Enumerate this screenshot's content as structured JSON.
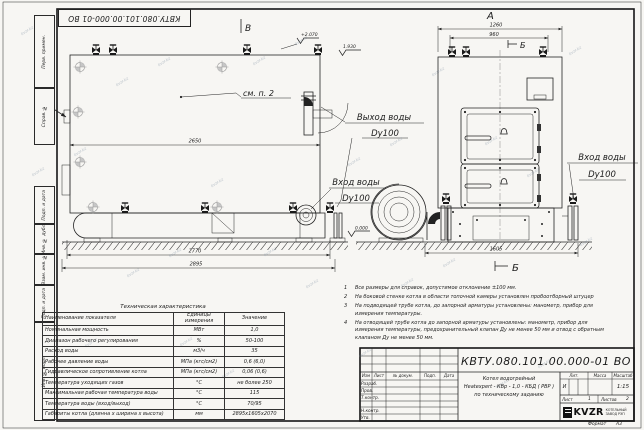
{
  "watermark": "kvzr.kz",
  "stamp_top": "КВТУ.080.101.00.000-01 ВО",
  "margin": {
    "perv_primen": "Перв. примен.",
    "sprav_no": "Справ. №",
    "podp_data_1": "Подп. и дата",
    "inv_dubl": "Инв. № дубл.",
    "vzam_inv": "Взам. инв. №",
    "podp_data_2": "Подп. и дата",
    "inv_podl": "Инв. № подл."
  },
  "drawing": {
    "view_a_label": "А",
    "view_b_label": "В",
    "section_b_top": "Б",
    "section_b_bottom": "Б",
    "marker_a": "А",
    "see_note": "см. п. 2",
    "elev_plus2070": "+2.070",
    "elev_1930": "1.930",
    "elev_0000": "0.000",
    "dim_2650": "2650",
    "dim_2770": "2770",
    "dim_2895": "2895",
    "dim_1260": "1260",
    "dim_960": "960",
    "dim_1605": "1605",
    "label_out_water": "Выход воды",
    "label_out_dn": "Dy100",
    "label_in_water_left": "Вход воды",
    "label_in_dn_left": "Dy100",
    "label_in_water_right": "Вход воды",
    "label_in_dn_right": "Dy100"
  },
  "notes": {
    "items": [
      {
        "num": "1",
        "text": "Все размеры для справок, допустимое отклонение ±100 мм."
      },
      {
        "num": "2",
        "text": "На боковой стенке котла в области топочной камеры установлен пробоотборный штуцер"
      },
      {
        "num": "3",
        "text": "На  подводящей трубе котла, до запорной арматуры установлены: манометр, прибор для измерения температуры."
      },
      {
        "num": "4",
        "text": "На отводящей трубе котла до запорной арматуры установлены: манометр, прибор для измерения температуры, предохранительный клапан Ду не менее 50 мм и отвод с обратным клапаном Ду не менее 50 мм."
      }
    ]
  },
  "tech_table": {
    "title": "Техническая характеристика",
    "col_name": "Наименование показателя",
    "col_unit": "Единицы измерения",
    "col_value": "Значение",
    "rows": [
      {
        "name": "Номинальная мощность",
        "unit": "МВт",
        "value": "1,0"
      },
      {
        "name": "Диапазон рабочего регулирования",
        "unit": "%",
        "value": "50-100"
      },
      {
        "name": "Расход воды",
        "unit": "м3/ч",
        "value": "35"
      },
      {
        "name": "Рабочее давление воды",
        "unit": "МПа (кгс/см2)",
        "value": "0,6 (6,0)"
      },
      {
        "name": "Гидравлическое сопротивление котла",
        "unit": "МПа (кгс/см2)",
        "value": "0,06 (0,6)"
      },
      {
        "name": "Температура уходящих газов",
        "unit": "°С",
        "value": "не более 250"
      },
      {
        "name": "Максимальная рабочая температура воды",
        "unit": "°С",
        "value": "115"
      },
      {
        "name": "Температура воды (вход/выход)",
        "unit": "°С",
        "value": "70/95"
      },
      {
        "name": "Габариты котла (длинна х ширина х высота)",
        "unit": "мм",
        "value": "2895х1605х2070"
      }
    ]
  },
  "title_block": {
    "doc_number": "КВТУ.080.101.00.000-01 ВО",
    "product_line1": "Котел водогрейный",
    "product_line2": "Heatexpert - КВр - 1,0 - КБД ( РВР )",
    "product_line3": "по техническому заданию",
    "hdr_izm": "Изм",
    "hdr_list": "Лист",
    "hdr_docum": "№ докум.",
    "hdr_podp": "Подп.",
    "hdr_data": "Дата",
    "role_razrab": "Разраб.",
    "role_prov": "Пров.",
    "role_tkontr": "Т.контр.",
    "role_nkontr": "Н.контр.",
    "role_utv": "Утв.",
    "hdr_lit": "Лит.",
    "hdr_massa": "Масса",
    "hdr_masshtab": "Масштаб",
    "lit_value": "И",
    "scale_value": "1:15",
    "sheet_label": "Лист",
    "sheet_value": "1",
    "sheets_label": "Листов",
    "sheets_value": "2",
    "logo_text": "KVZR",
    "logo_caption1": "КОТЕЛЬНЫЙ",
    "logo_caption2": "ЗАВОД РЭП",
    "format_label": "Формат",
    "format_value": "А3"
  }
}
